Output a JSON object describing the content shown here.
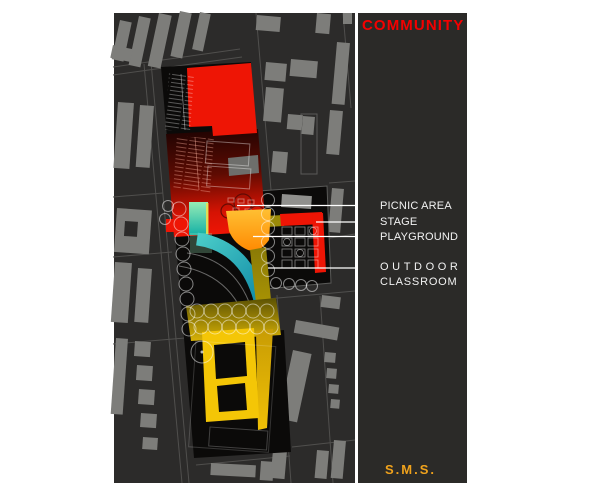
{
  "title": {
    "text": "COMMUNITY"
  },
  "legend": {
    "picnic_area": "PICNIC AREA",
    "stage": "STAGE",
    "playground": "PLAYGROUND",
    "outdoor_line1": "OUTDOOR",
    "outdoor_line2": "CLASSROOM"
  },
  "footer": {
    "text": "S.M.S."
  },
  "palette": {
    "title_red": "#f40000",
    "footer_orange": "#f0a21c",
    "label_white": "#f2f2f2",
    "panel_bg": "#2b2a28",
    "map_bg": "#2c2b2a",
    "building_gray": "#7d7d7a",
    "site_black": "#0b0a09",
    "feature_red": "#ee1505",
    "feature_orange": "#ff9410",
    "feature_teal": "#17acbe",
    "feature_yellow": "#f4c606",
    "leader_line": "#ffffff"
  }
}
